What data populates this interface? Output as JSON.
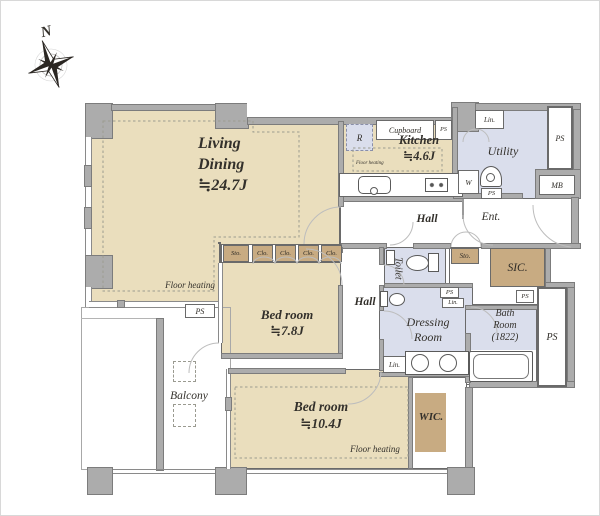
{
  "compass": {
    "north": "N"
  },
  "living": {
    "name": "Living\nDining\n≒24.7J",
    "floor_heating": "Floor heating",
    "ps": "PS"
  },
  "kitchen": {
    "name": "Kitchen\n≒4.6J",
    "cupboard": "Cupboard",
    "fridge": "R",
    "ps": "PS",
    "floor_heating": "Floor heating"
  },
  "utility": {
    "name": "Utility",
    "linen": "Lin.",
    "washer": "W",
    "ps": "PS"
  },
  "service": {
    "ps_top_right": "PS",
    "meter_box": "MB",
    "ps_right": "PS"
  },
  "entrance": {
    "name": "Ent."
  },
  "hall_upper": {
    "name": "Hall"
  },
  "hall_lower": {
    "name": "Hall"
  },
  "toilet": {
    "name": "Toilet",
    "storage": "Sto."
  },
  "sic": {
    "name": "SIC.",
    "ps": "PS"
  },
  "dressing": {
    "name": "Dressing\nRoom",
    "ps": "PS",
    "linen_upper": "Lin.",
    "linen_lower": "Lin."
  },
  "bath": {
    "name": "Bath\nRoom\n(1822)"
  },
  "bedroom1": {
    "name": "Bed room\n≒7.8J",
    "storage": "Sto.",
    "closets": [
      "Clo.",
      "Clo.",
      "Clo.",
      "Clo."
    ]
  },
  "bedroom2": {
    "name": "Bed room\n≒10.4J",
    "floor_heating": "Floor heating"
  },
  "wic": {
    "name": "WIC."
  },
  "balcony": {
    "name": "Balcony"
  },
  "colors": {
    "room_beige": "#EADEBD",
    "closet_tan": "#C8AB82",
    "wet_area_blue": "#DADEEC",
    "wall_gray": "#ACACAC"
  }
}
